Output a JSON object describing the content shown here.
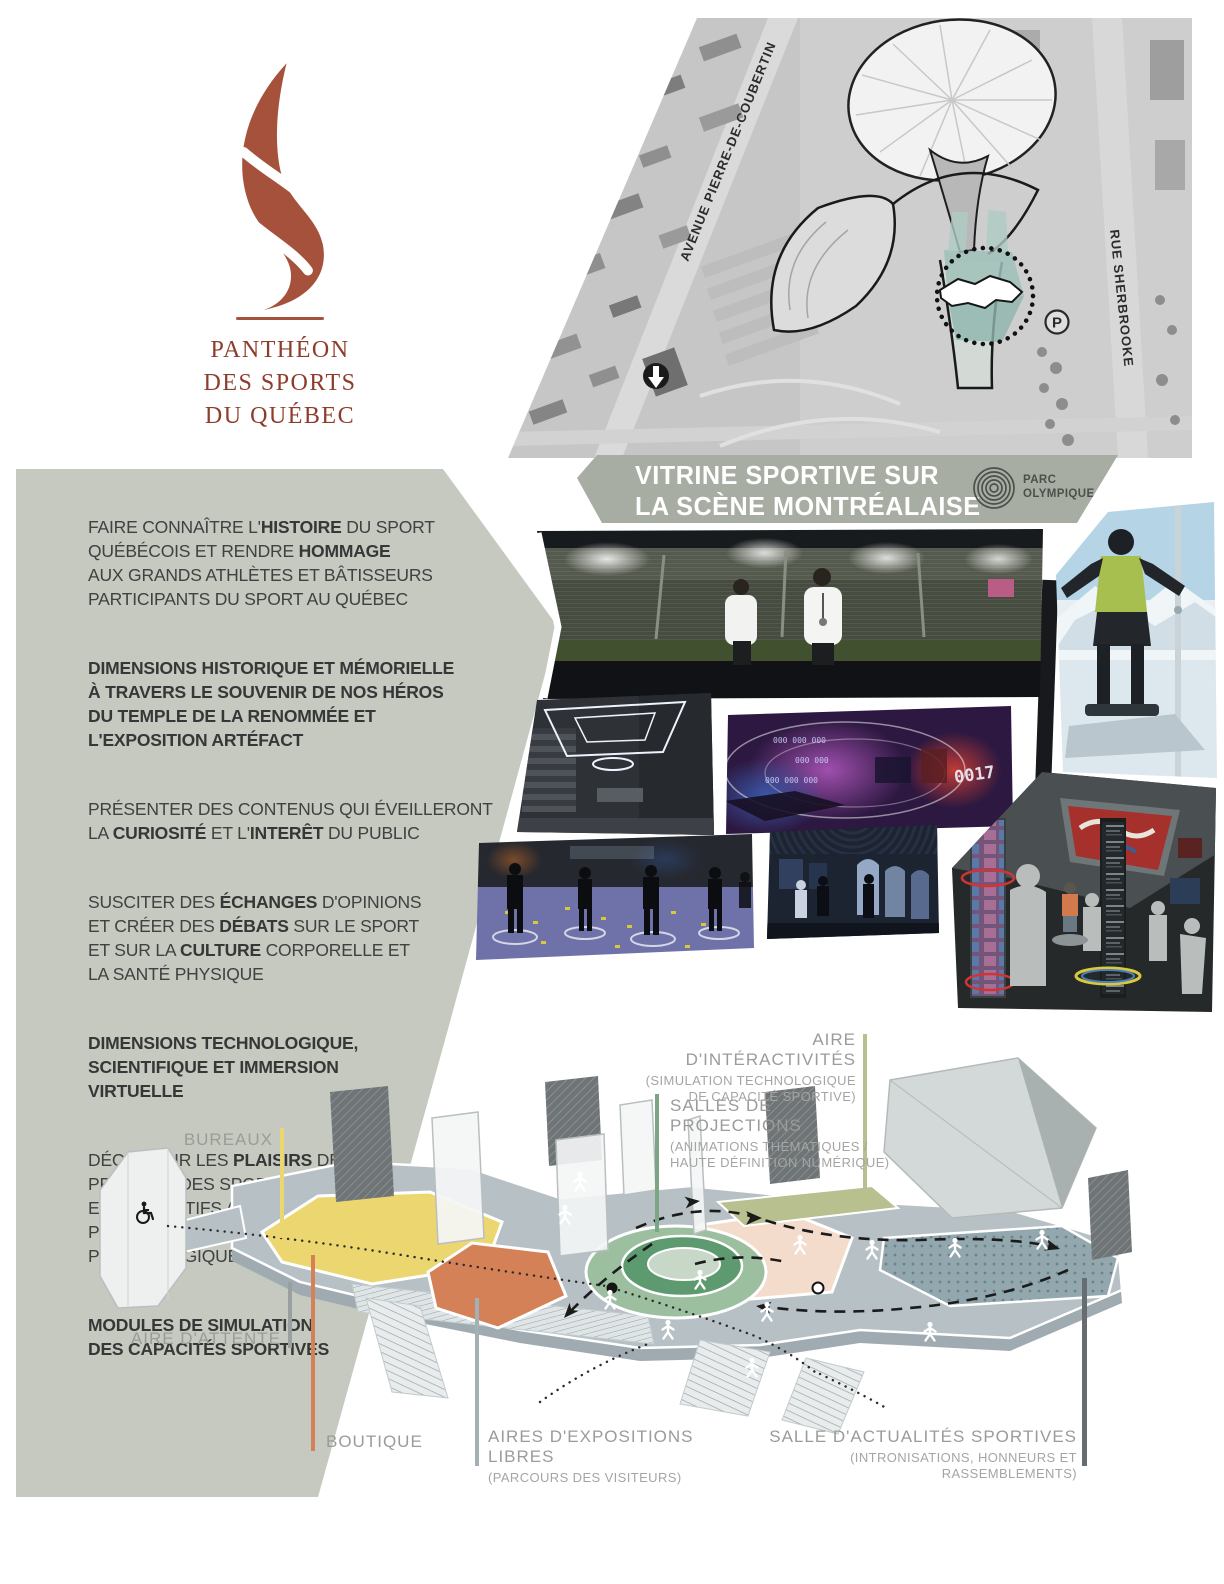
{
  "logo": {
    "line1": "PANTHÉON",
    "line2": "DES SPORTS",
    "line3": "DU QUÉBEC",
    "flame_color": "#a5513b",
    "text_color": "#8e3c2c"
  },
  "map": {
    "street_left": "AVENUE PIERRE-DE-COUBERTIN",
    "street_right": "RUE SHERBROOKE",
    "parking_label": "P"
  },
  "banner": {
    "line1_2": "VITRINE SPORTIVE SUR\nLA SCÈNE MONTRÉALAISE",
    "bg": "#a8ada3",
    "parc_logo": "PARC\nOLYMPIQUE"
  },
  "mission": {
    "panel_bg": "#c6c9c0",
    "paragraphs": [
      "FAIRE CONNAÎTRE L'**HISTOIRE** DU SPORT\nQUÉBÉCOIS ET RENDRE **HOMMAGE**\nAUX GRANDS ATHLÈTES ET BÂTISSEURS\nPARTICIPANTS DU SPORT AU QUÉBEC",
      "**DIMENSIONS HISTORIQUE ET MÉMORIELLE\nÀ TRAVERS LE SOUVENIR DE NOS HÉROS\nDU TEMPLE DE LA RENOMMÉE ET\nL'EXPOSITION ARTÉFACT**",
      "PRÉSENTER DES CONTENUS QUI ÉVEILLERONT\nLA **CURIOSITÉ** ET L'**INTERÊT** DU PUBLIC",
      "SUSCITER DES **ÉCHANGES** D'OPINIONS\nET CRÉER DES **DÉBATS** SUR LE SPORT\nET SUR LA **CULTURE** CORPORELLE ET\nLA SANTÉ PHYSIQUE",
      "**DIMENSIONS TECHNOLOGIQUE,\nSCIENTIFIQUE ET IMMERSION\nVIRTUELLE**",
      "DÉCOUVRIR LES **PLAISIRS** DELA\nPRATIQUE DES SPORTS DE COMPÉTITION\nET RÉCRÉATIFS AINSI QUE L'ACTIVITÉ\nPHYSIQUE EN VUE D'UN **BIEN-ÊTRE**\nPSYCHOLOGIQUE ET PHYSIQUE",
      "**MODULES DE SIMULATION\nDES CAPACITÉS SPORTIVES**"
    ]
  },
  "plan_labels": {
    "bureaux": {
      "title": "BUREAUX",
      "line_color": "#ecd66f",
      "zone_color": "#ecd66f"
    },
    "attente": {
      "title": "AIRE D'ATTENTE",
      "line_color": "#9aa0a0"
    },
    "boutique": {
      "title": "BOUTIQUE",
      "line_color": "#d58157",
      "zone_color": "#d58157"
    },
    "expositions": {
      "title": "AIRES D'EXPOSITIONS LIBRES",
      "sub": "(PARCOURS DES VISITEURS)",
      "line_color": "#a3b1b5"
    },
    "interactivites": {
      "title": "AIRE D'INTÉRACTIVITÉS",
      "sub": "(SIMULATION TECHNOLOGIQUE\nDE CAPACITÉ SPORTIVE)",
      "line_color": "#b7c08e",
      "zone_color": "#b7c08e"
    },
    "projections": {
      "title": "SALLES DE PROJECTIONS",
      "sub": "(ANIMATIONS THÉMATIQUES /\nHAUTE DÉFINITION NUMÉRIQUE)",
      "line_color": "#7ca584",
      "zone_color": "#5e9a70"
    },
    "actualites": {
      "title": "SALLE D'ACTUALITÉS SPORTIVES",
      "sub": "(INTRONISATIONS, HONNEURS ET RASSEMBLEMENTS)",
      "line_color": "#666c6f",
      "zone_color": "#8fa3ab"
    }
  }
}
